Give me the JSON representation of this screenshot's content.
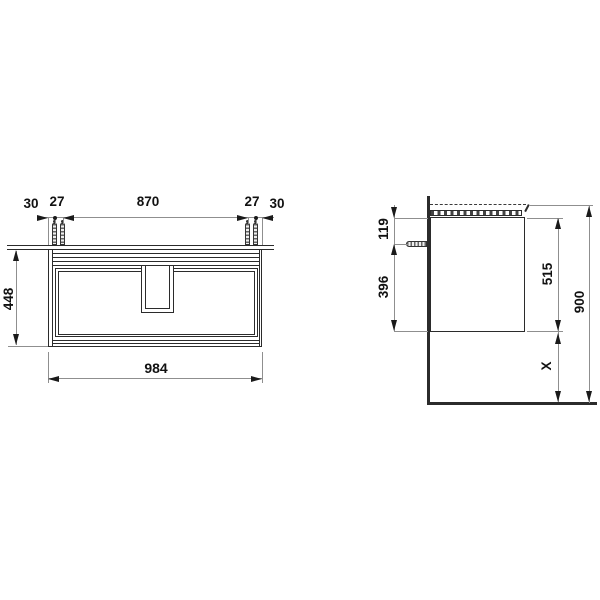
{
  "front": {
    "offset_left": "30",
    "pitch_left": "27",
    "span": "870",
    "pitch_right": "27",
    "offset_right": "30",
    "height": "448",
    "width": "984"
  },
  "side": {
    "top_to_bolt": "119",
    "bolt_to_bottom": "396",
    "body_height": "515",
    "mount_height": "900",
    "clearance": "X"
  },
  "colors": {
    "object_line": "#2b2b2b",
    "dimension_line": "#8f8f8f",
    "text": "#111111",
    "background": "#ffffff"
  }
}
